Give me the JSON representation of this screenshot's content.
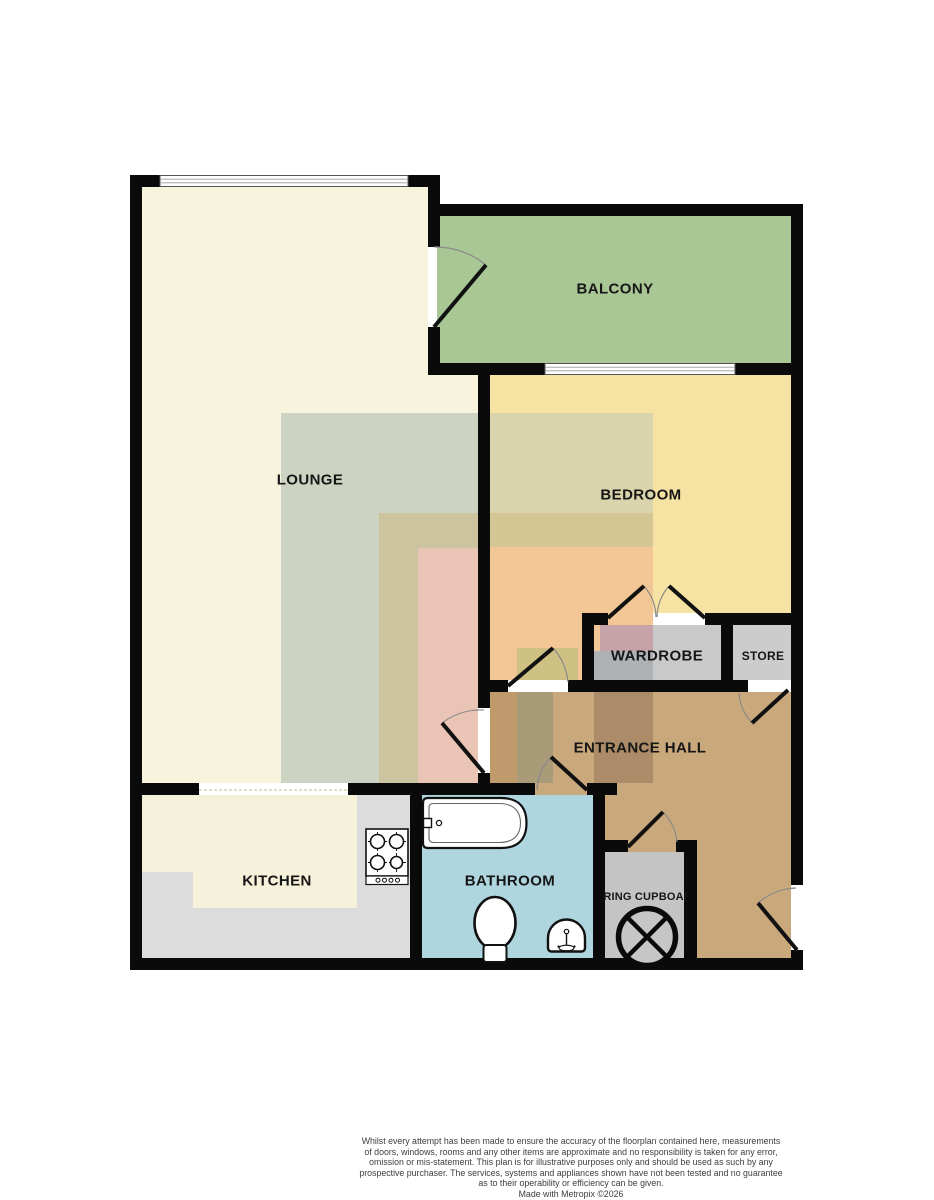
{
  "plan": {
    "rooms": {
      "lounge": {
        "label": "LOUNGE"
      },
      "balcony": {
        "label": "BALCONY"
      },
      "bedroom": {
        "label": "BEDROOM"
      },
      "wardrobe": {
        "label": "WARDROBE"
      },
      "store": {
        "label": "STORE"
      },
      "entrance_hall": {
        "label": "ENTRANCE HALL"
      },
      "kitchen": {
        "label": "KITCHEN"
      },
      "bathroom": {
        "label": "BATHROOM"
      },
      "airing_cupboard": {
        "label": "AIRING CUPBOARD"
      }
    },
    "colors": {
      "wall": "#0a0a0a",
      "lounge": "#f8f3dc",
      "balcony": "#a9c795",
      "bedroom": "#f6e3a4",
      "entrance_hall": "#c9a87c",
      "kitchen": "#dcdcdc",
      "bathroom": "#afd6df",
      "wardrobe": "#c9c9c9",
      "store": "#cccccc",
      "airing_cupboard": "#c4c4c4"
    },
    "fixtures": [
      "bathtub",
      "toilet",
      "sink",
      "hob",
      "hot-water-cylinder"
    ]
  },
  "footer": {
    "disclaimer": "Whilst every attempt has been made to ensure the accuracy of the floorplan contained here, measurements\nof doors, windows, rooms and any other items are approximate and no responsibility is taken for any error,\nomission or mis-statement. This plan is for illustrative purposes only and should be used as such by any\nprospective purchaser. The services, systems and appliances shown have not been tested and no guarantee\nas to their operability or efficiency can be given.",
    "credit": "Made with Metropix ©2026"
  }
}
